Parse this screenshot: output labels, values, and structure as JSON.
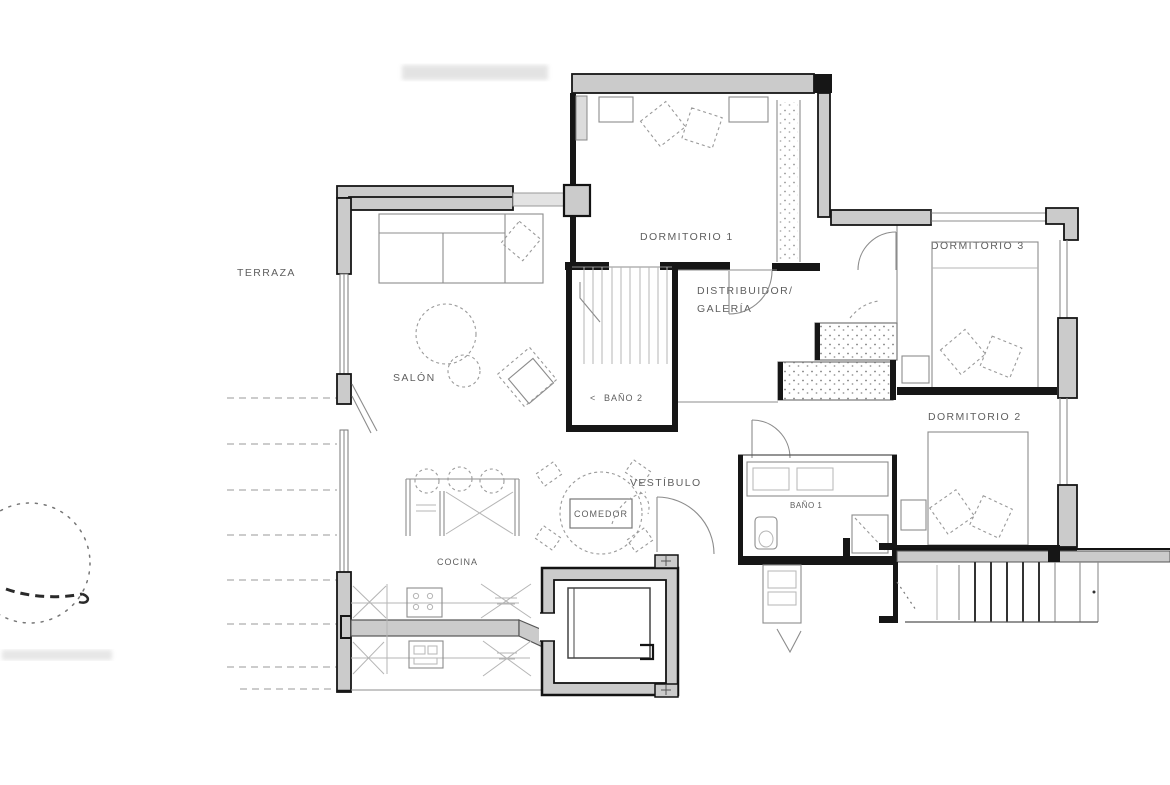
{
  "page": {
    "background": "#ffffff"
  },
  "plan": {
    "type": "apartment-floor-plan",
    "rooms": {
      "terraza": {
        "label": "TERRAZA"
      },
      "salon": {
        "label": "SALÓN"
      },
      "cocina": {
        "label": "COCINA"
      },
      "comedor": {
        "label": "COMEDOR"
      },
      "dormitorio1": {
        "label": "DORMITORIO 1"
      },
      "distribuidor": {
        "line1": "DISTRIBUIDOR/",
        "line2": "GALERÍA"
      },
      "bano2": {
        "arrow": "<",
        "label": "BAÑO 2"
      },
      "vestibulo": {
        "label": "VESTÍBULO"
      },
      "bano1": {
        "label": "BAÑO 1"
      },
      "dormitorio3": {
        "label": "DORMITORIO 3"
      },
      "dormitorio2": {
        "label": "DORMITORIO 2"
      }
    },
    "colors": {
      "wall_fill": "#cbcbcb",
      "wall_stroke": "#161616",
      "thin_line": "#8c8c8c",
      "dashed_line": "#9a9a9a",
      "label": "#5f5f5f",
      "background": "#ffffff"
    },
    "symbols": [
      "bed-symbol",
      "pillow-symbol",
      "sofa-symbol",
      "armchair-symbol",
      "round-table-symbol",
      "dining-table-symbol",
      "chair-symbol",
      "stool-symbol",
      "kitchen-bar-symbol",
      "stove-symbol",
      "appliance-symbol",
      "cabinet-x-symbol",
      "wardrobe-symbol",
      "vanity-symbol",
      "toilet-symbol",
      "shower-symbol",
      "elevator-symbol",
      "stairs-symbol",
      "door-swing-symbol",
      "window-symbol",
      "tree-sketch-symbol"
    ]
  }
}
